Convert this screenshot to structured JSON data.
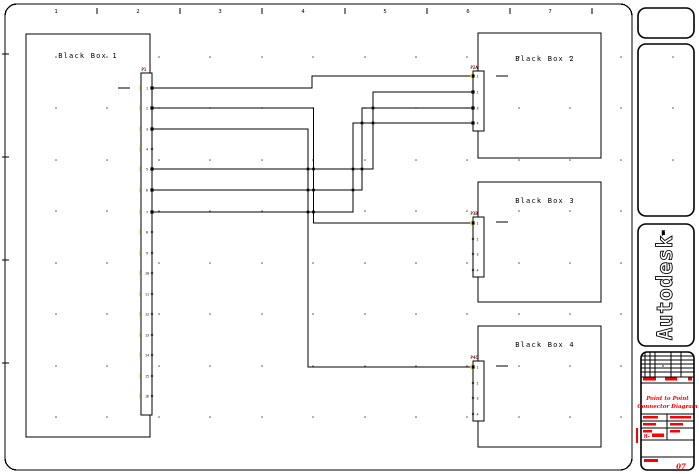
{
  "canvas": {
    "w": 699,
    "h": 474,
    "bg": "#ffffff"
  },
  "colors": {
    "line": "#000000",
    "red": "#ff0000",
    "dark_red": "#6d0d0d",
    "yellow": "#ffff00",
    "dot": "#555555"
  },
  "border": {
    "x": 5,
    "y": 4,
    "w": 627,
    "h": 466,
    "r": 12,
    "tick_ys": [
      54,
      157,
      260,
      363
    ]
  },
  "ruler": {
    "tick_xs": [
      97,
      180,
      262,
      345,
      427,
      510,
      592
    ],
    "numbers": [
      {
        "t": "1",
        "x": 56
      },
      {
        "t": "2",
        "x": 138
      },
      {
        "t": "3",
        "x": 220
      },
      {
        "t": "4",
        "x": 303
      },
      {
        "t": "5",
        "x": 385
      },
      {
        "t": "6",
        "x": 468
      },
      {
        "t": "7",
        "x": 550
      }
    ],
    "y_top": 8,
    "y_bot": 14,
    "num_y": 13
  },
  "grid": {
    "cols": [
      56,
      107,
      159,
      210,
      262,
      313,
      365,
      416,
      467,
      519,
      570,
      621
    ],
    "rows": [
      57,
      108,
      160,
      211,
      263,
      314,
      366,
      417
    ],
    "panel_dots": [
      [
        673,
        57
      ],
      [
        673,
        108
      ],
      [
        673,
        160
      ]
    ]
  },
  "boxes": [
    {
      "label": "Black Box 1",
      "x": 26,
      "y": 34,
      "w": 124,
      "h": 403,
      "lx": 88,
      "ly": 58
    },
    {
      "label": "Black Box 2",
      "x": 478,
      "y": 33,
      "w": 123,
      "h": 125,
      "lx": 545,
      "ly": 61
    },
    {
      "label": "Black Box 3",
      "x": 478,
      "y": 182,
      "w": 123,
      "h": 120,
      "lx": 545,
      "ly": 203
    },
    {
      "label": "Black Box 4",
      "x": 478,
      "y": 326,
      "w": 123,
      "h": 121,
      "lx": 545,
      "ly": 347
    }
  ],
  "stubs": [
    [
      118,
      88,
      130,
      88
    ],
    [
      496,
      76,
      508,
      76
    ],
    [
      496,
      222,
      508,
      222
    ],
    [
      496,
      366,
      508,
      366
    ]
  ],
  "wires": [
    {
      "name": "wire-bb1p1-bb2p1",
      "pts": [
        [
          152,
          88
        ],
        [
          312,
          88
        ],
        [
          312,
          76
        ],
        [
          473,
          76
        ]
      ]
    },
    {
      "name": "wire-bb1p2-bb3p1",
      "pts": [
        [
          152,
          108
        ],
        [
          313.5,
          108
        ],
        [
          313.5,
          223
        ],
        [
          473,
          223
        ]
      ]
    },
    {
      "name": "wire-bb1p3-bb4p1",
      "pts": [
        [
          152,
          129
        ],
        [
          308,
          129
        ],
        [
          308,
          367
        ],
        [
          473,
          367
        ]
      ]
    },
    {
      "name": "wire-bb1p5-bb2p2",
      "pts": [
        [
          152,
          169
        ],
        [
          373,
          169
        ],
        [
          373,
          92
        ],
        [
          473,
          92
        ]
      ]
    },
    {
      "name": "wire-bb1p6-bb2p3",
      "pts": [
        [
          152,
          190
        ],
        [
          362,
          190
        ],
        [
          362,
          108
        ],
        [
          473,
          108
        ]
      ]
    },
    {
      "name": "wire-bb1p7-bb2p4",
      "pts": [
        [
          152,
          212
        ],
        [
          353,
          212
        ],
        [
          353,
          123
        ],
        [
          473,
          123
        ]
      ]
    }
  ],
  "crossings": [
    [
      308,
      169
    ],
    [
      313.5,
      169
    ],
    [
      353,
      169
    ],
    [
      362,
      169
    ],
    [
      308,
      190
    ],
    [
      313.5,
      190
    ],
    [
      353,
      190
    ],
    [
      308,
      212
    ],
    [
      313.5,
      212
    ],
    [
      373,
      108
    ],
    [
      362,
      123
    ],
    [
      373,
      123
    ]
  ],
  "connectors": [
    {
      "tag": "P1",
      "x": 141,
      "y": 73,
      "w": 11,
      "h": 342,
      "side": "right",
      "tagx": 141.5,
      "tagy": 71,
      "pins": [
        {
          "n": "1",
          "y": 88,
          "w": 1
        },
        {
          "n": "2",
          "y": 108,
          "w": 1
        },
        {
          "n": "3",
          "y": 129,
          "w": 1
        },
        {
          "n": "4",
          "y": 149,
          "w": 0
        },
        {
          "n": "5",
          "y": 169,
          "w": 1
        },
        {
          "n": "6",
          "y": 190,
          "w": 1
        },
        {
          "n": "7",
          "y": 212,
          "w": 1
        },
        {
          "n": "8",
          "y": 232,
          "w": 0
        },
        {
          "n": "9",
          "y": 253,
          "w": 0
        },
        {
          "n": "10",
          "y": 273,
          "w": 0
        },
        {
          "n": "11",
          "y": 294,
          "w": 0
        },
        {
          "n": "12",
          "y": 314,
          "w": 0
        },
        {
          "n": "13",
          "y": 335,
          "w": 0
        },
        {
          "n": "14",
          "y": 355,
          "w": 0
        },
        {
          "n": "15",
          "y": 376,
          "w": 0
        },
        {
          "n": "16",
          "y": 396,
          "w": 0
        }
      ]
    },
    {
      "tag": "P2A",
      "x": 473,
      "y": 71,
      "w": 11,
      "h": 60,
      "side": "left",
      "tagx": 470.5,
      "tagy": 69,
      "pins": [
        {
          "n": "1",
          "y": 76,
          "w": 1
        },
        {
          "n": "2",
          "y": 92,
          "w": 1
        },
        {
          "n": "3",
          "y": 108,
          "w": 1
        },
        {
          "n": "4",
          "y": 123,
          "w": 1
        }
      ]
    },
    {
      "tag": "P3B",
      "x": 473,
      "y": 217,
      "w": 11,
      "h": 60,
      "side": "left",
      "tagx": 470.5,
      "tagy": 215,
      "pins": [
        {
          "n": "1",
          "y": 223,
          "w": 1
        },
        {
          "n": "2",
          "y": 239,
          "w": 0
        },
        {
          "n": "3",
          "y": 254,
          "w": 0
        },
        {
          "n": "4",
          "y": 270,
          "w": 0
        }
      ]
    },
    {
      "tag": "P4C",
      "x": 473,
      "y": 361,
      "w": 11,
      "h": 60,
      "side": "left",
      "tagx": 470.5,
      "tagy": 359,
      "pins": [
        {
          "n": "1",
          "y": 367,
          "w": 1
        },
        {
          "n": "2",
          "y": 383,
          "w": 0
        },
        {
          "n": "3",
          "y": 398,
          "w": 0
        },
        {
          "n": "4",
          "y": 414,
          "w": 0
        }
      ]
    }
  ],
  "panels": [
    {
      "name": "side-panel-top",
      "x": 638,
      "y": 8,
      "w": 56,
      "h": 30,
      "r": 8
    },
    {
      "name": "side-panel-tall",
      "x": 638,
      "y": 44,
      "w": 56,
      "h": 172,
      "r": 8
    },
    {
      "name": "autodesk-logo-panel",
      "x": 638,
      "y": 224,
      "w": 56,
      "h": 122,
      "r": 8
    },
    {
      "name": "title-block-panel",
      "x": 641,
      "y": 352,
      "w": 53,
      "h": 118,
      "r": 6
    }
  ],
  "logo": {
    "text": "Autodesk",
    "tm": "™",
    "cx": 666,
    "cy": 285
  },
  "title_block": {
    "table": {
      "x1": 641,
      "x2": 694,
      "top": 352,
      "bot": 377,
      "hlines": [
        356,
        360,
        364,
        368,
        372,
        377
      ],
      "vlines": [
        645,
        650,
        655,
        671,
        681
      ],
      "dot": [
        663,
        366
      ]
    },
    "hlines": [
      383,
      414,
      421,
      428,
      440,
      457
    ],
    "vline": {
      "x": 667,
      "y1": 414,
      "y2": 440
    },
    "bars": [
      [
        643,
        377.5,
        13,
        3
      ],
      [
        665,
        377.5,
        12,
        3
      ],
      [
        688,
        377.5,
        4,
        3
      ],
      [
        643,
        416,
        15,
        2.5
      ],
      [
        670,
        416,
        21,
        2.5
      ],
      [
        643,
        423,
        13,
        2.5
      ],
      [
        670,
        423,
        13,
        2.5
      ],
      [
        643,
        430,
        9,
        2.5
      ],
      [
        670,
        430,
        10,
        2.5
      ],
      [
        652,
        433.5,
        12,
        3.5
      ],
      [
        644,
        459,
        14,
        3
      ]
    ],
    "dot": [
      667,
      424
    ],
    "side_bar": [
      636,
      428,
      2,
      15
    ],
    "title1": "Point to Point",
    "title2": "Connector Diagram",
    "field_label": "H-",
    "sheet_no": "07"
  }
}
